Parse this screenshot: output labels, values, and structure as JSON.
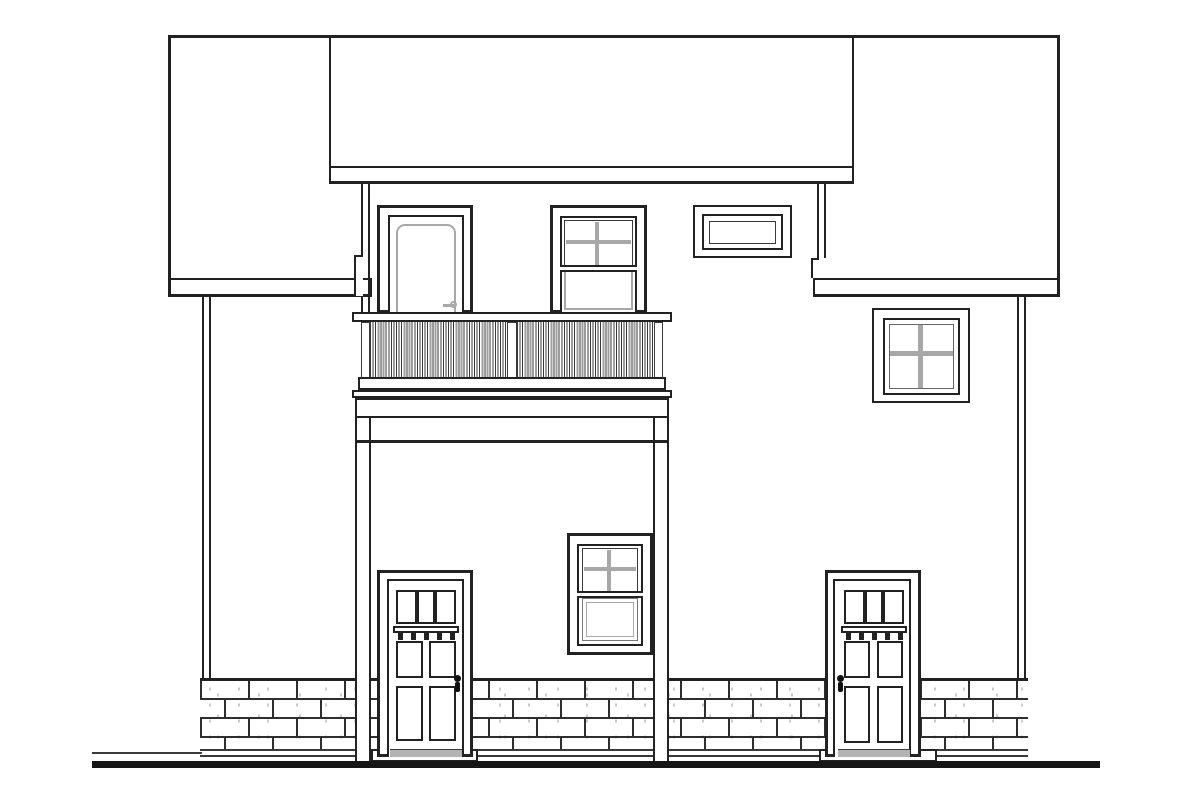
{
  "colors": {
    "ink": "#222222",
    "ink-soft": "#3a3a3a",
    "slab": "#a8a8a8",
    "muntin": "#a8a8a8",
    "speckle": "#c6c6c6",
    "paper": "#ffffff",
    "ground": "#161616",
    "mortar": "#2e2e2e",
    "baluster-dark": "#3a3a3a",
    "baluster-gray": "#9e9e9e",
    "thresh": "#b3b3b3"
  },
  "scene": {
    "kind": "black-and-white architectural elevation line drawing of a two-story house rear facade",
    "balcony_rail_sections": 2,
    "balcony_posts": 3,
    "doors_ground_floor": 2,
    "door_glass_panes": 3,
    "door_dentils": 5,
    "door_panels": 4,
    "upper_floor_openings": [
      "glazed door",
      "double-hung window with 4-pane upper sash",
      "small fixed transom window"
    ],
    "ground_floor_openings": [
      "panel door",
      "double-hung window with 4-pane upper sash",
      "panel door"
    ],
    "side_wing_window_panes": 4,
    "foundation": "running-bond brick band",
    "text_labels": []
  }
}
